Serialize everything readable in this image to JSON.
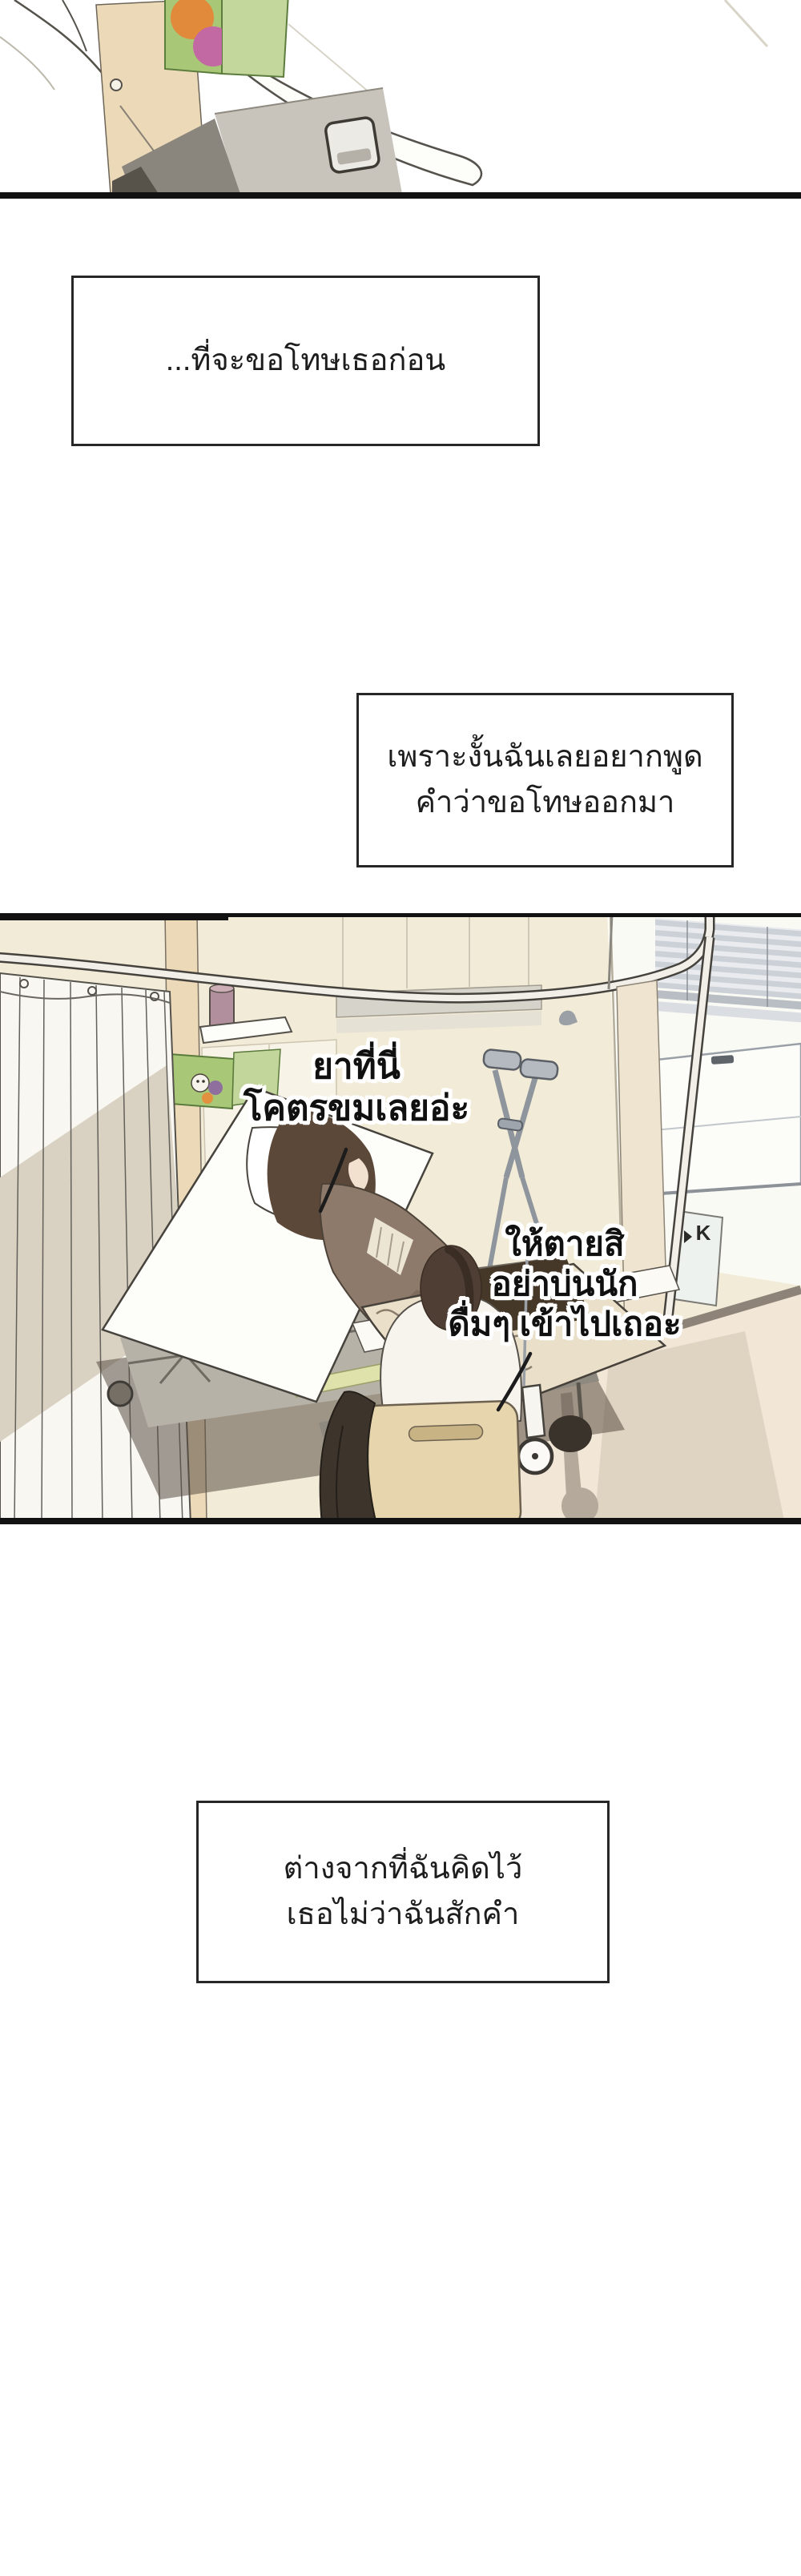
{
  "page": {
    "type": "webtoon-comic-page",
    "background": "#ffffff"
  },
  "narration": {
    "box1": {
      "line1": "...ที่จะขอโทษเธอก่อน"
    },
    "box2": {
      "line1": "เพราะงั้นฉันเลยอยากพูด",
      "line2": "คำว่าขอโทษออกมา"
    },
    "box3": {
      "line1": "ต่างจากที่ฉันคิดไว้",
      "line2": "เธอไม่ว่าฉันสักคำ"
    }
  },
  "speech": {
    "bubble1": {
      "line1": "ยาที่นี่",
      "line2": "โคตรขมเลยอ่ะ"
    },
    "bubble2": {
      "line1": "ให้ตายสิ",
      "line2": "อย่าบ่นนัก",
      "line3": "ดื่มๆ เข้าไปเถอะ"
    }
  },
  "sign": {
    "label": "K"
  },
  "panels": {
    "top_scene_alt": "Close-up of a wooden bedside cabinet with a white counter, a green juice box and a grey drawer",
    "main_scene_alt": "Hospital room: a patient reclines in a raised bed while a visitor sits on a wooden chair beside the bed; crutches lean on the wall and a curtain hangs on the left"
  },
  "colors": {
    "panel_border": "#141414",
    "text": "#1d1d1d",
    "wall_cream": "#f2ebd7",
    "curtain_shadow": "#d9d1c1",
    "wood": "#ebd9b8",
    "green_box": "#a9c877",
    "orange_circle": "#e28a3c",
    "pink_circle": "#c268a2",
    "blanket": "#eadfc8",
    "cardigan": "#8e7a6a",
    "hair_dark": "#4e3e33",
    "chair_wood": "#e7d5ae",
    "bed_rail_green": "#dfe3ab",
    "floor": "#f2e6d6",
    "blinds": "#ccd1d7"
  }
}
